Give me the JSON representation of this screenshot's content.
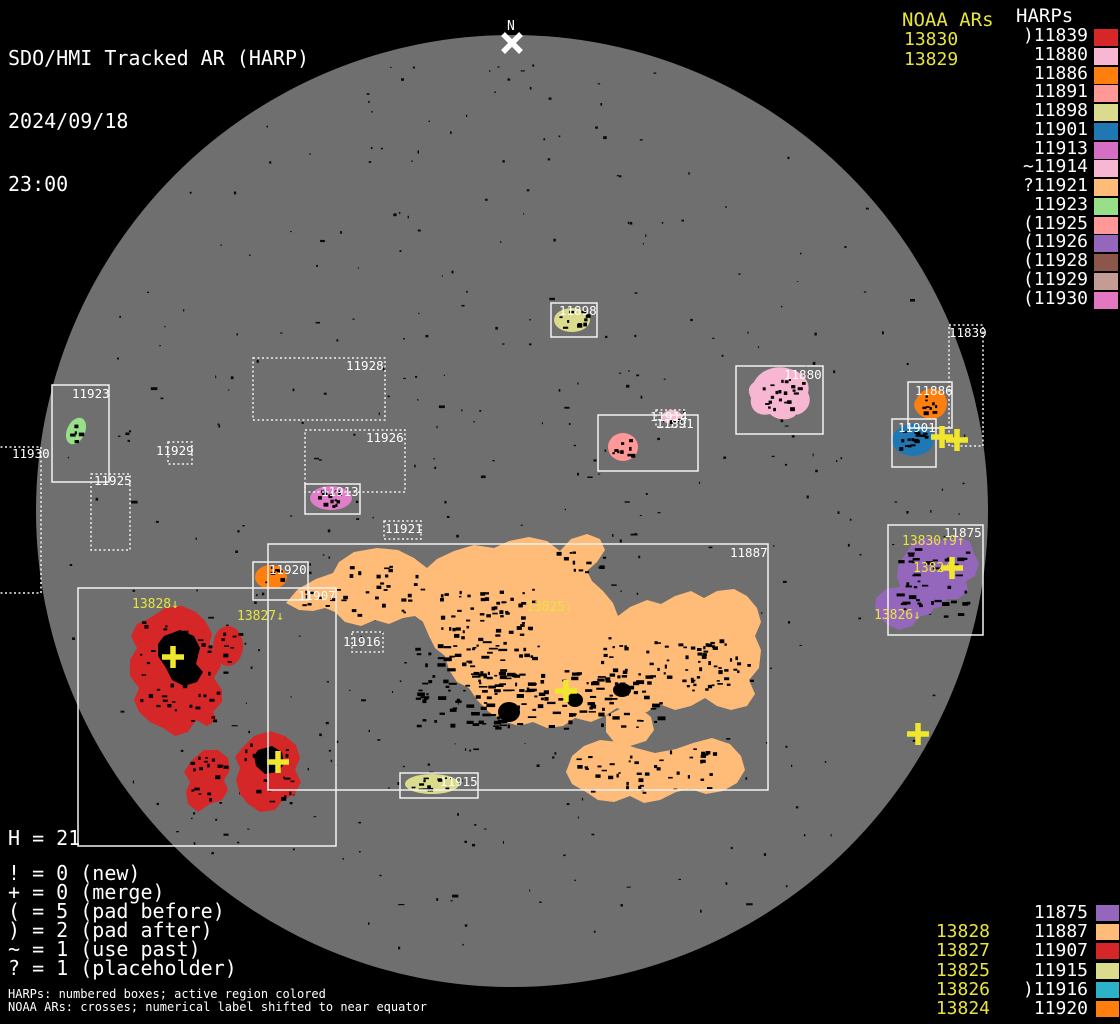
{
  "header": {
    "title": "SDO/HMI Tracked AR (HARP)",
    "date": "2024/09/18",
    "time": "23:00"
  },
  "palette": {
    "background": "#000000",
    "disk": "#6f6f6f",
    "box_stroke": "#f2f2f2",
    "noaa_yellow": "#e8e43c",
    "cross_yellow": "#f0e62e",
    "label_white": "#ffffff",
    "speck_black": "#0a0a0a",
    "north_white": "#ffffff"
  },
  "top_right": {
    "noaa_title": "NOAA ARs",
    "noaa_items": [
      "13830",
      "13829"
    ],
    "harps_title": "HARPs",
    "harp_items": [
      {
        "label": ")11839",
        "color": "#d62728"
      },
      {
        "label": "11880",
        "color": "#f7b6d2"
      },
      {
        "label": "11886",
        "color": "#ff7f0e"
      },
      {
        "label": "11891",
        "color": "#ff9896"
      },
      {
        "label": "11898",
        "color": "#dbdb8d"
      },
      {
        "label": "11901",
        "color": "#1f77b4"
      },
      {
        "label": "11913",
        "color": "#d66fc4"
      },
      {
        "label": "~11914",
        "color": "#f7b6d2"
      },
      {
        "label": "?11921",
        "color": "#ffbb78"
      },
      {
        "label": "11923",
        "color": "#98df8a"
      },
      {
        "label": "(11925",
        "color": "#ff9896"
      },
      {
        "label": "(11926",
        "color": "#9467bd"
      },
      {
        "label": "(11928",
        "color": "#8c564b"
      },
      {
        "label": "(11929",
        "color": "#c49c94"
      },
      {
        "label": "(11930",
        "color": "#e377c2"
      }
    ]
  },
  "bottom_right": {
    "noaa_items": [
      "",
      "13828",
      "13827",
      "13825",
      "13826",
      "13824"
    ],
    "harp_items": [
      {
        "label": "11875",
        "color": "#9467bd"
      },
      {
        "label": "11887",
        "color": "#ffbb78"
      },
      {
        "label": "11907",
        "color": "#d62728"
      },
      {
        "label": "11915",
        "color": "#dbdb8d"
      },
      {
        "label": ")11916",
        "color": "#2cb1c7"
      },
      {
        "label": "11920",
        "color": "#ff7f0e"
      }
    ]
  },
  "stats": {
    "histogram": "H = 21",
    "lines": [
      "! = 0 (new)",
      "+ = 0 (merge)",
      "( = 5 (pad before)",
      ") = 2 (pad after)",
      "~ = 1 (use past)",
      "? = 1 (placeholder)"
    ]
  },
  "footnotes": [
    "HARPs: numbered boxes; active region colored",
    "NOAA ARs: crosses; numerical label shifted to near equator"
  ],
  "disk": {
    "cx": 512,
    "cy": 511,
    "r": 476
  },
  "north_marker": {
    "label": "N",
    "x": 512,
    "y": 43
  },
  "harp_boxes": [
    {
      "id": "11923",
      "x": 52,
      "y": 385,
      "w": 57,
      "h": 97,
      "style": "solid",
      "lx": 72,
      "ly": 387
    },
    {
      "id": "11930",
      "x": -22,
      "y": 447,
      "w": 63,
      "h": 146,
      "style": "dotted",
      "lx": 12,
      "ly": 447
    },
    {
      "id": "11925",
      "x": 91,
      "y": 474,
      "w": 39,
      "h": 76,
      "style": "dotted",
      "lx": 94,
      "ly": 474
    },
    {
      "id": "11929",
      "x": 168,
      "y": 442,
      "w": 24,
      "h": 22,
      "style": "dotted",
      "lx": 156,
      "ly": 444
    },
    {
      "id": "11928",
      "x": 253,
      "y": 358,
      "w": 132,
      "h": 62,
      "style": "dotted",
      "lx": 346,
      "ly": 359
    },
    {
      "id": "11926",
      "x": 305,
      "y": 430,
      "w": 100,
      "h": 62,
      "style": "dotted",
      "lx": 366,
      "ly": 431
    },
    {
      "id": "11913",
      "x": 305,
      "y": 484,
      "w": 55,
      "h": 30,
      "style": "solid",
      "lx": 321,
      "ly": 485
    },
    {
      "id": "11921",
      "x": 384,
      "y": 521,
      "w": 37,
      "h": 18,
      "style": "dotted",
      "lx": 385,
      "ly": 522
    },
    {
      "id": "11898",
      "x": 551,
      "y": 303,
      "w": 46,
      "h": 34,
      "style": "solid",
      "lx": 559,
      "ly": 304
    },
    {
      "id": "11914",
      "x": 656,
      "y": 410,
      "w": 29,
      "h": 17,
      "style": "dotted",
      "lx": 650,
      "ly": 410
    },
    {
      "id": "11891",
      "x": 598,
      "y": 415,
      "w": 100,
      "h": 56,
      "style": "solid",
      "lx": 656,
      "ly": 417
    },
    {
      "id": "11880",
      "x": 736,
      "y": 366,
      "w": 87,
      "h": 68,
      "style": "solid",
      "lx": 784,
      "ly": 368
    },
    {
      "id": "11886",
      "x": 908,
      "y": 382,
      "w": 44,
      "h": 46,
      "style": "solid",
      "lx": 915,
      "ly": 384
    },
    {
      "id": "11901",
      "x": 892,
      "y": 419,
      "w": 44,
      "h": 48,
      "style": "solid",
      "lx": 898,
      "ly": 421
    },
    {
      "id": "11839",
      "x": 949,
      "y": 325,
      "w": 34,
      "h": 121,
      "style": "dotted",
      "lx": 949,
      "ly": 326
    },
    {
      "id": "11875",
      "x": 888,
      "y": 525,
      "w": 95,
      "h": 110,
      "style": "solid",
      "lx": 944,
      "ly": 526
    },
    {
      "id": "11920",
      "x": 253,
      "y": 562,
      "w": 55,
      "h": 38,
      "style": "solid",
      "lx": 269,
      "ly": 563
    },
    {
      "id": "11907",
      "x": 78,
      "y": 588,
      "w": 258,
      "h": 258,
      "style": "solid",
      "lx": 298,
      "ly": 589
    },
    {
      "id": "11887",
      "x": 268,
      "y": 544,
      "w": 500,
      "h": 246,
      "style": "solid",
      "lx": 730,
      "ly": 546
    },
    {
      "id": "11916",
      "x": 352,
      "y": 632,
      "w": 31,
      "h": 20,
      "style": "dotted",
      "lx": 343,
      "ly": 635
    },
    {
      "id": "11915",
      "x": 400,
      "y": 773,
      "w": 78,
      "h": 25,
      "style": "solid",
      "lx": 440,
      "ly": 775
    }
  ],
  "noaa_crosses": [
    {
      "x": 173,
      "y": 657
    },
    {
      "x": 278,
      "y": 762
    },
    {
      "x": 566,
      "y": 691
    },
    {
      "x": 952,
      "y": 568
    },
    {
      "x": 942,
      "y": 437
    },
    {
      "x": 957,
      "y": 440
    },
    {
      "x": 918,
      "y": 734
    }
  ],
  "noaa_labels": [
    {
      "text": "13828↓",
      "x": 132,
      "y": 608
    },
    {
      "text": "13827↓",
      "x": 237,
      "y": 620
    },
    {
      "text": "13825↓",
      "x": 526,
      "y": 611
    },
    {
      "text": "13830↑9↑",
      "x": 902,
      "y": 545
    },
    {
      "text": "13824",
      "x": 913,
      "y": 572
    },
    {
      "text": "13826↓",
      "x": 874,
      "y": 619
    }
  ],
  "regions": [
    {
      "id": "11887",
      "color": "#ffbb78",
      "shapes": [
        {
          "t": "p",
          "d": "M286,603 L298,589 L316,579 L333,573 L339,562 L354,552 L377,548 L398,550 L414,558 L427,568 L437,559 L454,551 L474,545 L494,548 L509,541 L529,537 L547,541 L560,551 L571,539 L587,534 L600,539 L605,550 L597,562 L587,571 L592,581 L603,591 L613,603 L618,616 L630,607 L647,600 L661,604 L675,596 L691,591 L704,598 L717,591 L734,589 L747,596 L757,608 L761,622 L755,636 L761,650 L759,668 L749,680 L755,694 L747,706 L731,710 L717,706 L705,698 L691,706 L675,710 L659,704 L647,712 L631,714 L617,708 L605,716 L591,722 L575,718 L563,726 L547,728 L533,722 L519,726 L503,721 L489,712 L477,700 L469,688 L457,682 L449,670 L445,656 L435,648 L429,636 L423,622 L415,616 L403,618 L389,624 L375,620 L361,626 L345,622 L335,612 L325,608 L313,611 L299,610 Z"
        },
        {
          "t": "p",
          "d": "M566,772 L572,756 L584,746 L600,740 L618,742 L636,748 L655,753 L676,749 L693,743 L712,738 L730,744 L741,756 L745,770 L737,783 L723,791 L706,794 L690,789 L676,792 L660,800 L644,803 L630,796 L614,802 L598,800 L586,792 L572,784 Z"
        },
        {
          "t": "p",
          "d": "M606,716 L622,708 L640,708 L651,717 L654,730 L646,741 L630,746 L614,742 L606,732 Z"
        }
      ],
      "spots": [
        {
          "x": 440,
          "y": 588,
          "w": 95,
          "h": 50,
          "n": 55
        },
        {
          "x": 415,
          "y": 640,
          "w": 130,
          "h": 85,
          "n": 95,
          "s": 1
        },
        {
          "x": 470,
          "y": 668,
          "w": 190,
          "h": 60,
          "n": 110,
          "s": 1
        },
        {
          "x": 600,
          "y": 636,
          "w": 120,
          "h": 55,
          "n": 45
        },
        {
          "x": 555,
          "y": 548,
          "w": 50,
          "h": 25,
          "n": 12
        },
        {
          "x": 690,
          "y": 640,
          "w": 60,
          "h": 45,
          "n": 30
        },
        {
          "x": 575,
          "y": 748,
          "w": 140,
          "h": 45,
          "n": 45
        },
        {
          "x": 335,
          "y": 565,
          "w": 90,
          "h": 50,
          "n": 28
        },
        {
          "x": 295,
          "y": 588,
          "w": 40,
          "h": 18,
          "n": 8
        }
      ]
    },
    {
      "id": "11887-core",
      "color": "#000000",
      "shapes": [
        {
          "t": "e",
          "cx": 509,
          "cy": 712,
          "rx": 11,
          "ry": 10
        },
        {
          "t": "e",
          "cx": 575,
          "cy": 700,
          "rx": 8,
          "ry": 7
        },
        {
          "t": "e",
          "cx": 622,
          "cy": 690,
          "rx": 9,
          "ry": 7
        }
      ],
      "spots": []
    },
    {
      "id": "11907",
      "color": "#d62728",
      "shapes": [
        {
          "t": "p",
          "d": "M150,618 L165,608 L182,606 L196,612 L206,622 L212,634 L209,646 L218,654 L221,666 L214,678 L222,690 L222,702 L213,712 L217,720 L207,726 L196,720 L188,732 L175,736 L163,728 L150,722 L139,712 L134,700 L139,688 L130,676 L130,660 L137,648 L131,636 L137,624 Z"
        },
        {
          "t": "e",
          "cx": 228,
          "cy": 646,
          "rx": 15,
          "ry": 20
        },
        {
          "t": "p",
          "d": "M192,760 L204,750 L218,750 L228,758 L230,770 L224,780 L228,790 L222,800 L210,804 L198,812 L188,804 L186,792 L190,782 L184,772 Z"
        },
        {
          "t": "p",
          "d": "M242,748 L254,736 L270,731 L285,736 L296,745 L300,758 L295,770 L301,782 L295,794 L283,800 L275,810 L260,812 L248,804 L240,794 L236,780 L240,768 L235,757 Z"
        }
      ],
      "spots": [
        {
          "x": 140,
          "y": 618,
          "w": 85,
          "h": 105,
          "n": 45
        },
        {
          "x": 218,
          "y": 632,
          "w": 22,
          "h": 30,
          "n": 8
        },
        {
          "x": 190,
          "y": 756,
          "w": 38,
          "h": 48,
          "n": 18
        },
        {
          "x": 242,
          "y": 742,
          "w": 52,
          "h": 60,
          "n": 22
        }
      ]
    },
    {
      "id": "11907-core",
      "color": "#000000",
      "shapes": [
        {
          "t": "p",
          "d": "M164,636 L180,630 L194,636 L200,648 L196,664 L203,672 L197,682 L184,686 L172,680 L166,668 L158,656 L158,644 Z"
        },
        {
          "t": "p",
          "d": "M258,750 L272,746 L282,752 L284,764 L278,772 L265,774 L256,766 L254,756 Z"
        }
      ],
      "spots": []
    },
    {
      "id": "11875",
      "color": "#9467bd",
      "shapes": [
        {
          "t": "p",
          "d": "M904,556 L912,544 L928,537 L944,541 L958,536 L970,542 L974,554 L979,563 L975,576 L966,581 L968,591 L958,599 L947,599 L940,607 L926,609 L918,603 L908,612 L896,614 L890,607 L897,596 L900,585 L897,578 L898,566 Z"
        },
        {
          "t": "p",
          "d": "M876,598 L886,589 L900,587 L911,594 L922,590 L933,594 L936,604 L930,614 L919,617 L912,626 L899,630 L888,625 L879,617 L875,607 Z"
        }
      ],
      "spots": [
        {
          "x": 896,
          "y": 548,
          "w": 72,
          "h": 72,
          "n": 42,
          "s": 1
        }
      ]
    },
    {
      "id": "11880",
      "color": "#f7b6d2",
      "shapes": [
        {
          "t": "p",
          "d": "M754,382 C760,370 776,364 790,369 C803,372 811,382 808,393 C813,402 807,413 796,415 C790,421 777,421 770,414 C759,417 749,410 751,398 C747,390 749,386 754,382 Z"
        }
      ],
      "spots": [
        {
          "x": 758,
          "y": 376,
          "w": 45,
          "h": 38,
          "n": 22
        }
      ]
    },
    {
      "id": "11886",
      "color": "#ff7f0e",
      "shapes": [
        {
          "t": "p",
          "d": "M917,398 C921,389 932,386 941,391 C948,396 949,407 943,414 C936,421 924,420 918,413 C913,407 913,403 917,398 Z"
        }
      ],
      "spots": [
        {
          "x": 920,
          "y": 394,
          "w": 22,
          "h": 22,
          "n": 9
        }
      ]
    },
    {
      "id": "11901",
      "color": "#1f77b4",
      "shapes": [
        {
          "t": "e",
          "cx": 913,
          "cy": 440,
          "rx": 21,
          "ry": 16
        }
      ],
      "spots": [
        {
          "x": 898,
          "y": 430,
          "w": 30,
          "h": 20,
          "n": 16
        }
      ]
    },
    {
      "id": "11891",
      "color": "#ff9896",
      "shapes": [
        {
          "t": "e",
          "cx": 623,
          "cy": 447,
          "rx": 15,
          "ry": 14
        }
      ],
      "spots": [
        {
          "x": 612,
          "y": 436,
          "w": 22,
          "h": 20,
          "n": 10
        }
      ]
    },
    {
      "id": "11914",
      "color": "#f7b6d2",
      "shapes": [
        {
          "t": "e",
          "cx": 672,
          "cy": 417,
          "rx": 10,
          "ry": 7
        }
      ],
      "spots": [
        {
          "x": 666,
          "y": 412,
          "w": 14,
          "h": 9,
          "n": 4
        }
      ]
    },
    {
      "id": "11898",
      "color": "#dbdb8d",
      "shapes": [
        {
          "t": "e",
          "cx": 572,
          "cy": 320,
          "rx": 18,
          "ry": 12
        }
      ],
      "spots": [
        {
          "x": 558,
          "y": 310,
          "w": 30,
          "h": 18,
          "n": 10
        }
      ]
    },
    {
      "id": "11913",
      "color": "#e07fc8",
      "shapes": [
        {
          "t": "e",
          "cx": 331,
          "cy": 498,
          "rx": 21,
          "ry": 12
        }
      ],
      "spots": [
        {
          "x": 318,
          "y": 490,
          "w": 26,
          "h": 16,
          "n": 12
        }
      ]
    },
    {
      "id": "11923",
      "color": "#98df8a",
      "shapes": [
        {
          "t": "e",
          "cx": 76,
          "cy": 431,
          "rx": 9,
          "ry": 14,
          "rot": 25
        }
      ],
      "spots": [
        {
          "x": 70,
          "y": 424,
          "w": 12,
          "h": 16,
          "n": 5
        }
      ]
    },
    {
      "id": "11920",
      "color": "#ff7f0e",
      "shapes": [
        {
          "t": "e",
          "cx": 271,
          "cy": 577,
          "rx": 16,
          "ry": 12
        }
      ],
      "spots": [
        {
          "x": 262,
          "y": 566,
          "w": 20,
          "h": 18,
          "n": 7
        }
      ]
    },
    {
      "id": "11915",
      "color": "#dbdb8d",
      "shapes": [
        {
          "t": "e",
          "cx": 432,
          "cy": 784,
          "rx": 27,
          "ry": 10
        }
      ],
      "spots": [
        {
          "x": 410,
          "y": 777,
          "w": 45,
          "h": 13,
          "n": 14
        }
      ]
    }
  ]
}
